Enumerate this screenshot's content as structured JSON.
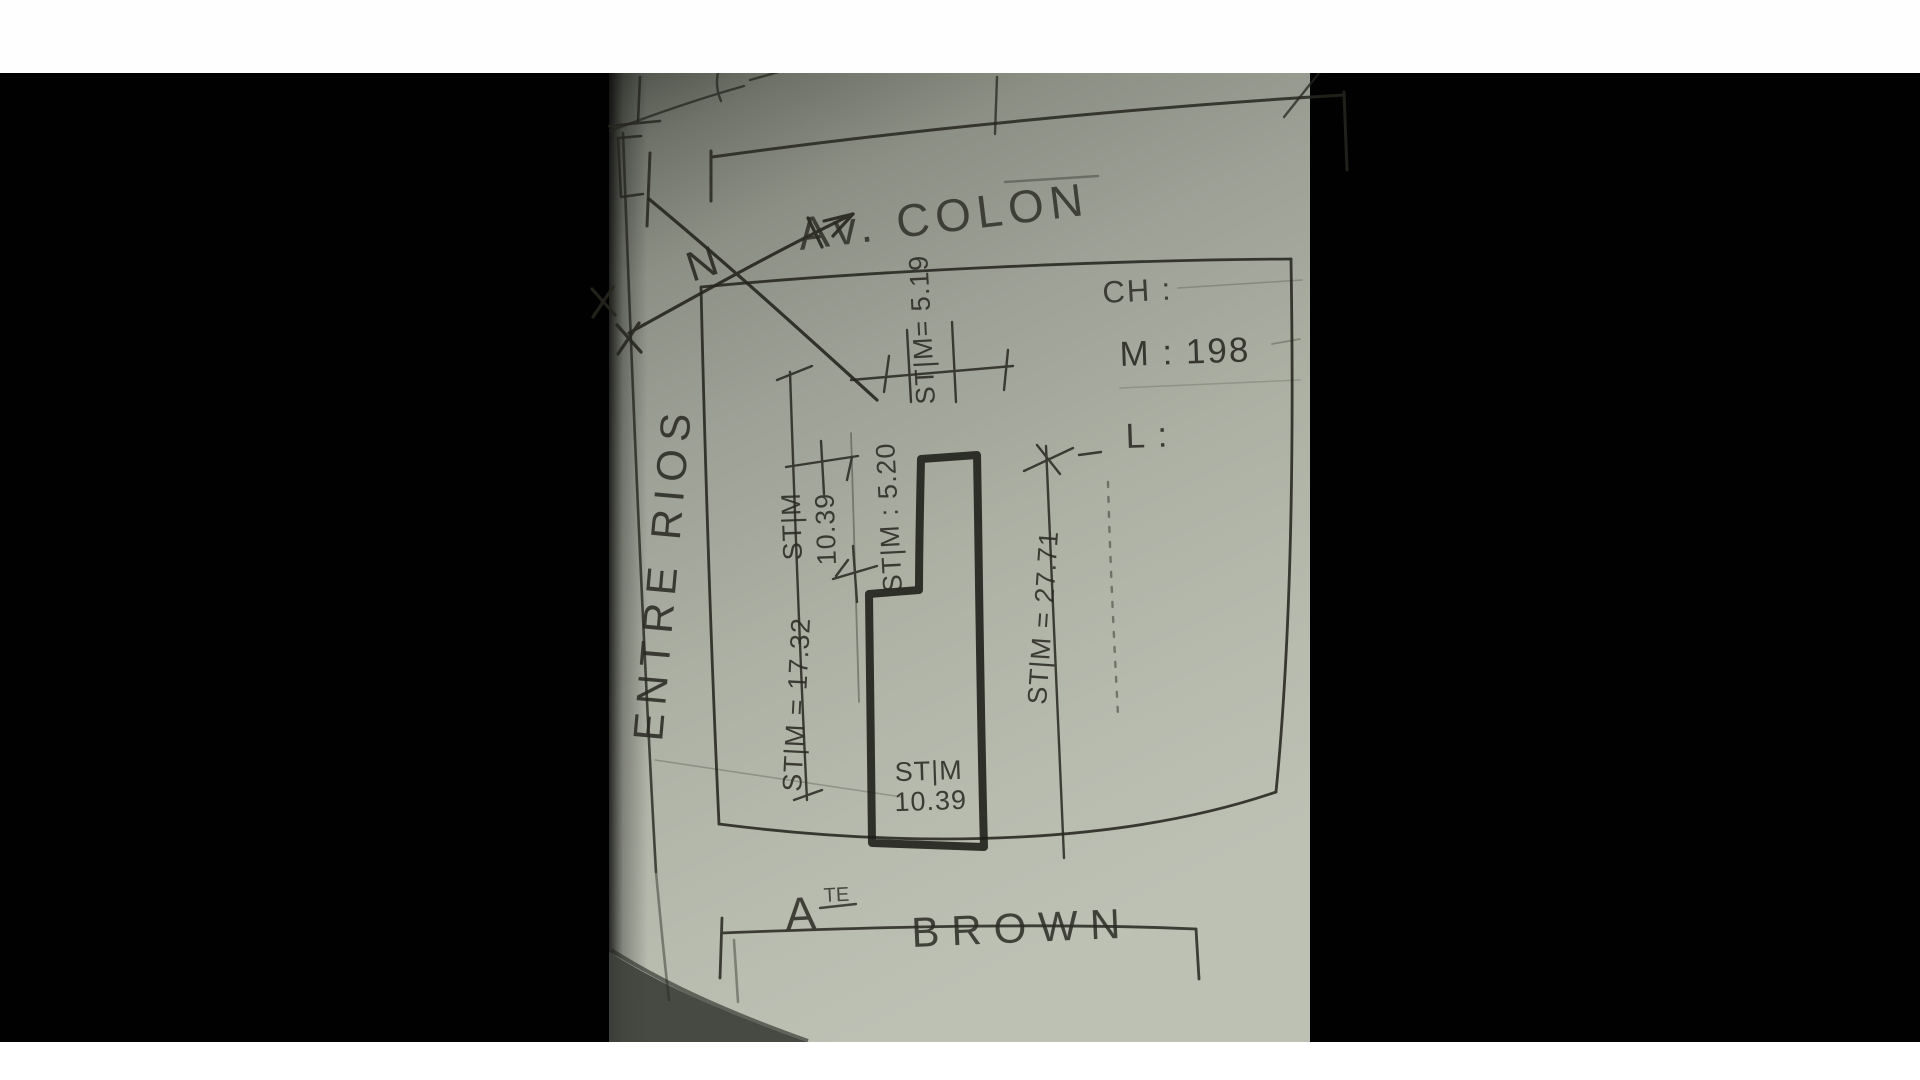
{
  "plan": {
    "streets": {
      "top": "Av. COLON",
      "left": "ENTRE RIOS",
      "bottom_prefix": "A",
      "bottom_prefix_sup": "TE",
      "bottom": "BROWN"
    },
    "north_label": "N",
    "info_panel": {
      "ch": "CH :",
      "m": "M : 198",
      "l": "L :"
    },
    "dimensions": {
      "top_width": "ST|M= 5.19",
      "step_width": "ST|M : 5.20",
      "upper_width_line1": "ST|M",
      "upper_width_line2": "10.39",
      "west_depth": "ST|M = 17.32",
      "east_depth": "ST|M = 27.71",
      "bottom_width_line1": "ST|M",
      "bottom_width_line2": "10.39"
    }
  }
}
